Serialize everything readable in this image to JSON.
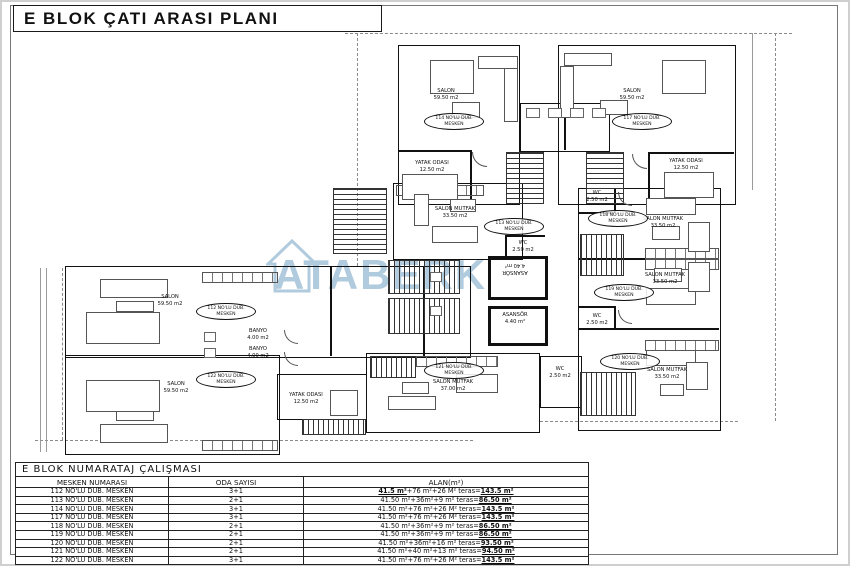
{
  "page": {
    "title": "E BLOK ÇATI ARASI PLANI"
  },
  "colors": {
    "watermark": "#9dbdd6",
    "line": "#111111"
  },
  "watermark": {
    "initial": "A",
    "rest": "TABERK"
  },
  "plan": {
    "units": [
      "114 NO'LU DUB.\nMESKEN",
      "117 NO'LU DUB.\nMESKEN",
      "113 NO'LU DUB.\nMESKEN",
      "118 NO'LU DUB.\nMESKEN",
      "119 NO'LU DUB.\nMESKEN",
      "120 NO'LU DUB.\nMESKEN",
      "121 NO'LU DUB.\nMESKEN",
      "112 NO'LU DUB.\nMESKEN",
      "122 NO'LU DUB.\nMESKEN"
    ],
    "rooms": [
      "SALON\n59.50 m2",
      "SALON\n59.50 m2",
      "SALON MUTFAK\n33.50 m2",
      "SALON MUTFAK\n33.50 m2",
      "SALON MUTFAK\n33.50 m2",
      "SALON MUTFAK\n33.50 m2",
      "SALON MUTFAK\n37.00 m2",
      "SALON\n59.50 m2",
      "SALON\n59.50 m2",
      "YATAK ODASI\n12.50 m2",
      "YATAK ODASI\n12.50 m2",
      "YATAK ODASI\n12.50 m2",
      "WC\n2.50 m2",
      "WC\n2.50 m2",
      "WC\n2.50 m2",
      "WC\n2.50 m2",
      "ASANSÖR\n4.40 m²",
      "ASANSÖR\n4.40 m²",
      "BANYO\n4.00 m2",
      "BANYO\n4.00 m2"
    ]
  },
  "table": {
    "title": "E BLOK NUMARATAJ ÇALIŞMASI",
    "columns": [
      "MESKEN NUMARASI",
      "ODA SAYISI",
      "ALAN(m²)"
    ],
    "rows": [
      {
        "mesken": "112 NO'LU DUB. MESKEN",
        "oda": "3+1",
        "lead": "41.5 m²",
        "alan": "+76 m²+26 M² teras=",
        "total": "143.5 m²"
      },
      {
        "mesken": "113 NO'LU DUB. MESKEN",
        "oda": "2+1",
        "lead": "",
        "alan": "41.50 m²+36m²+9 m² teras=",
        "total": "86.50 m²"
      },
      {
        "mesken": "114 NO'LU DUB. MESKEN",
        "oda": "3+1",
        "lead": "",
        "alan": "41.50 m²+76 m²+26 M² teras=",
        "total": "143.5 m²"
      },
      {
        "mesken": "117 NO'LU DUB. MESKEN",
        "oda": "3+1",
        "lead": "",
        "alan": "41.50 m²+76 m²+26 M² teras=",
        "total": "143.5 m²"
      },
      {
        "mesken": "118 NO'LU DUB. MESKEN",
        "oda": "2+1",
        "lead": "",
        "alan": "41.50 m²+36m²+9 m² teras=",
        "total": "86.50 m²"
      },
      {
        "mesken": "119 NO'LU DUB. MESKEN",
        "oda": "2+1",
        "lead": "",
        "alan": "41.50 m²+36m²+9 m² teras=",
        "total": "86.50 m²"
      },
      {
        "mesken": "120 NO'LU DUB. MESKEN",
        "oda": "2+1",
        "lead": "",
        "alan": "41.50 m²+36m²+16 m² teras=",
        "total": "93.50 m²"
      },
      {
        "mesken": "121 NO'LU DUB. MESKEN",
        "oda": "2+1",
        "lead": "",
        "alan": "41.50 m²+40 m²+13 m² teras=",
        "total": "94.50 m²"
      },
      {
        "mesken": "122 NO'LU DUB. MESKEN",
        "oda": "3+1",
        "lead": "",
        "alan": "41.50 m²+76 m²+26 M² teras=",
        "total": "143.5 m²"
      }
    ]
  }
}
